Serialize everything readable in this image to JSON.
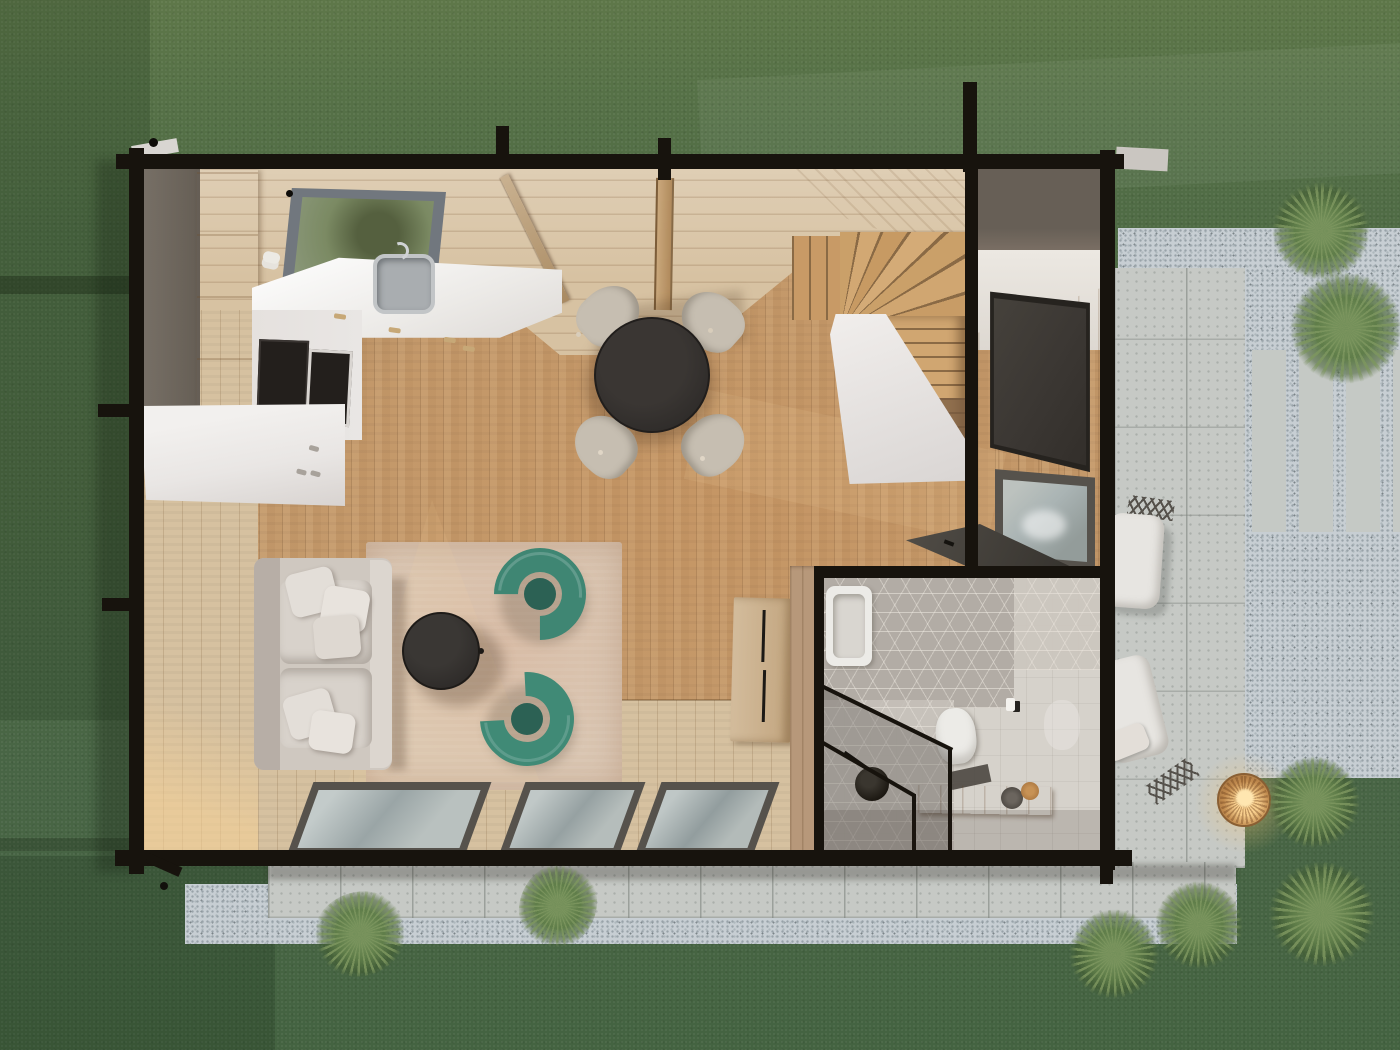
{
  "scene": {
    "kind": "3d-floor-plan-render",
    "view": "top-down bird's eye",
    "subject": "tiny house with open living space, bathroom, winder staircase, side patio and lawn"
  },
  "rooms": [
    {
      "name": "kitchen",
      "features": [
        "tall cabinet column",
        "white u-counter",
        "sink with faucet",
        "cooktop",
        "oven",
        "kitchen island",
        "ceiling skylight"
      ]
    },
    {
      "name": "dining-area",
      "features": [
        "round black table",
        "four beige chairs"
      ]
    },
    {
      "name": "living-area",
      "features": [
        "cream sofa with pillows",
        "round black coffee table",
        "two green armchairs",
        "beige rug",
        "three south glass windows"
      ]
    },
    {
      "name": "staircase",
      "features": [
        "winder stairs",
        "white stair base"
      ]
    },
    {
      "name": "media-wall",
      "features": [
        "wall tv",
        "window to patio",
        "fold-down desk"
      ]
    },
    {
      "name": "bathroom",
      "features": [
        "hex tile wall",
        "bathtub",
        "wall hung toilet",
        "glass shower with black frame",
        "rain shower head",
        "wood bench with towels",
        "toilet paper holder"
      ]
    },
    {
      "name": "patio",
      "features": [
        "concrete pavers",
        "gravel strips",
        "two lounge chairs",
        "rattan lantern glowing",
        "concrete slab path"
      ]
    },
    {
      "name": "garden",
      "features": [
        "lawn",
        "ornamental grass plants",
        "concrete walkway"
      ]
    }
  ],
  "palette": {
    "grass_base": "#4d6843",
    "grass_light": "#5e7749",
    "grass_dark": "#3f5e3b",
    "gravel": "#c7ced3",
    "gravel_speckle": "#99a3a9",
    "concrete": "#c6c9c5",
    "slab": "#c5c9c5",
    "beam_black": "#17130d",
    "wood_floor": "#c49a6c",
    "wood_floor_sun": "#d9b384",
    "wall_plank": "#d6c1a0",
    "ceiling_plank": "#d7c2a2",
    "stair_wood": "#c89a66",
    "stair_wood_dark": "#8a6a45",
    "stair_shadow_brown": "#7a5c41",
    "roof_remnant": "#6e665c",
    "cabinet_wood": "#cbb18b",
    "counter_white": "#eceae7",
    "island_white": "#e9e6e4",
    "appliance_black": "#231f1c",
    "sink_grey": "#a9adb0",
    "sofa_cream": "#cfc8c0",
    "pillow_white": "#e3ded8",
    "rug_beige": "#d9c5b1",
    "armchair_green": "#3f8673",
    "armchair_seat": "#2c6154",
    "table_black": "#2e2b29",
    "chair_beige": "#c6beb1",
    "tv_dark": "#3b3733",
    "window_frame": "#56524c",
    "glass_grey": "#aab4b4",
    "skylight_green": "#7b8a63",
    "skylight_frame": "#71777e",
    "hex_tile": "#b2aca5",
    "bath_floor": "#d6d2cb",
    "bench_wood": "#b8874e",
    "fixture_white": "#ecebe7",
    "lantern_glow": "#f5c878",
    "lantern_body": "#c08a4e",
    "outdoor_cushion": "#e7e5e1",
    "plant_core": "#74905a",
    "plant_mid": "#5f7d49"
  }
}
